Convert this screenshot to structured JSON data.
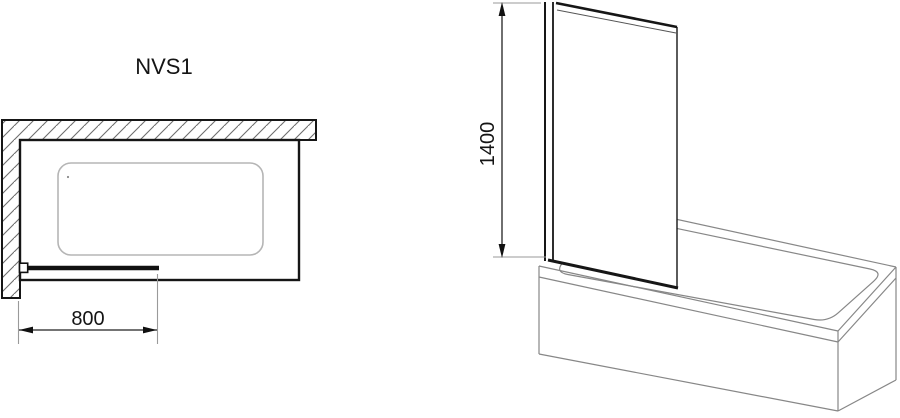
{
  "page": {
    "background_color": "#ffffff",
    "primary_line_color": "#161616",
    "secondary_line_color": "#878787",
    "light_line_color": "#b5b5b5",
    "dimension_line_color": "#222222",
    "extension_line_color": "#9a9a9a"
  },
  "product": {
    "model": "NVS1"
  },
  "top_view": {
    "description": "plan view of bathtub in wall corner with pivoting bath screen",
    "width_dimension": {
      "value": "800"
    }
  },
  "side_view": {
    "description": "perspective view of bath screen panel mounted on bathtub",
    "height_dimension": {
      "value": "1400"
    }
  }
}
